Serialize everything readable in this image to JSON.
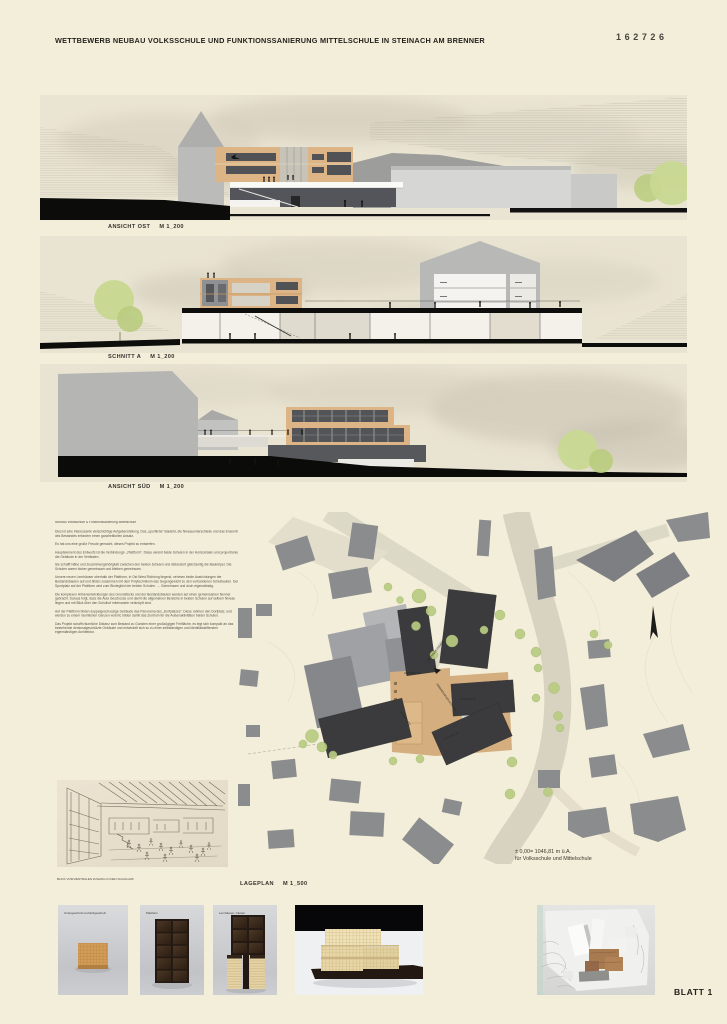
{
  "header": {
    "title": "WETTBEWERB NEUBAU VOLKSSCHULE UND FUNKTIONSSANIERUNG MITTELSCHULE IN STEINACH AM BRENNER",
    "entry_number": "162726"
  },
  "drawings": [
    {
      "label": "ANSICHT OST",
      "scale": "M 1_200"
    },
    {
      "label": "SCHNITT A",
      "scale": "M 1_200"
    },
    {
      "label": "ANSICHT SÜD",
      "scale": "M 1_200"
    }
  ],
  "description": {
    "title": "Neubau Volksschule & Funktionssanierung Mittelschule",
    "paragraphs": [
      "Dies ist eine interessante vielschichtige Aufgabenstellung. Das „sportliche“ Baufeld, die Niveauunterschiede und das Ensemble des Bestandes erfordern einen ganzheitlichen Ansatz.",
      "Es hat uns eine große Freude gemacht, dieses Projekt zu entwerfen.",
      "Hauptelement des Entwurfs ist die Verbindungs- „Plattform“. Diese vereint beide Schulen in der Horizontalen und proportioniert die Gebäude in der Vertikalen.",
      "Sie schafft Nähe und Zusammengehörigkeit zwischen den beiden Schulen und distanziert gleichzeitig die Baukörper. Die Schulen waren bisher gemeinsam und bleiben gemeinsam.",
      "Unsere neuen Lernhäuser oberhalb der Plattform, in Ost West Richtung liegend, nehmen beide Ausrichtungen der Bestandsbauten auf und bilden zusammen mit dem Polytechnikum das Gegengewicht zu den vorhandenen Schulbauten. Der Sportplatz auf der Plattform wird zum Bindeglied der beiden Schulen. → Gemeinsam und doch eigenständig.",
      "Die komplexen Höhenentwicklungen des Grundstücks und der Bestandsbauten werden auf einen gemeinsamen Nenner gebracht. Daraus folgt, dass die Aula Geschosse und damit die allgemeinen Bereiche in beiden Schulen auf selbem Niveau liegen und mit Blick über den Schulhof miteinander verknüpft sind.",
      "Auf der Plattform bilden doppelgeschossige Gebäude das Panorama des „Dorfplatzes“. Diese rahmen den Dorfplatz, und werden zu einem räumlichen Ganzen vereint, bilden damit das Zentrum für die Außenaktivitäten beider Schulen.",
      "Das Projekt schafft räumliche Distanz zum Bestand zu Gunsten einer großzügigen Freifläche, es legt sich kompakt an das bestehende denkmalgeschützte Gebäude und entwickelt sich so zu einer selbständigen und identitätsstiftenden eigenständigen Architektur."
    ]
  },
  "siteplan": {
    "label": "LAGEPLAN",
    "scale": "M 1_500",
    "elevation_note": {
      "line1": "± 0,00= 1046,81 m ü.A.",
      "line2": "für Volksschule und Mittelschule"
    },
    "labels": {
      "cluster_ms": "CLUSTER MS",
      "cluster_vs": "CLUSTER VS",
      "cluster_vs2": "CLUSTER VS",
      "sportplatz": "SPORTPLATZ",
      "plattform": "VERBINDUNGSPLATTFORM",
      "zugang": "ZENTRALER ZUGANG"
    }
  },
  "sketch": {
    "caption": "BLICK VOM ZENTRALEN ZUGANG IN DEN SCHULHOF"
  },
  "model_photos": [
    {
      "caption": "Untergeschoß und Erdgeschoß"
    },
    {
      "caption": "Plattform"
    },
    {
      "caption": "Lernhäuser, Cluster"
    },
    {
      "caption": ""
    }
  ],
  "footer": {
    "sheet_label": "BLATT 1"
  },
  "colors": {
    "board_bg": "#f3eed9",
    "accent_tan": "#dcb485",
    "tree_green": "#c6d78f",
    "charcoal": "#3b3b3d",
    "plan_grey": "#8b8c8e"
  }
}
